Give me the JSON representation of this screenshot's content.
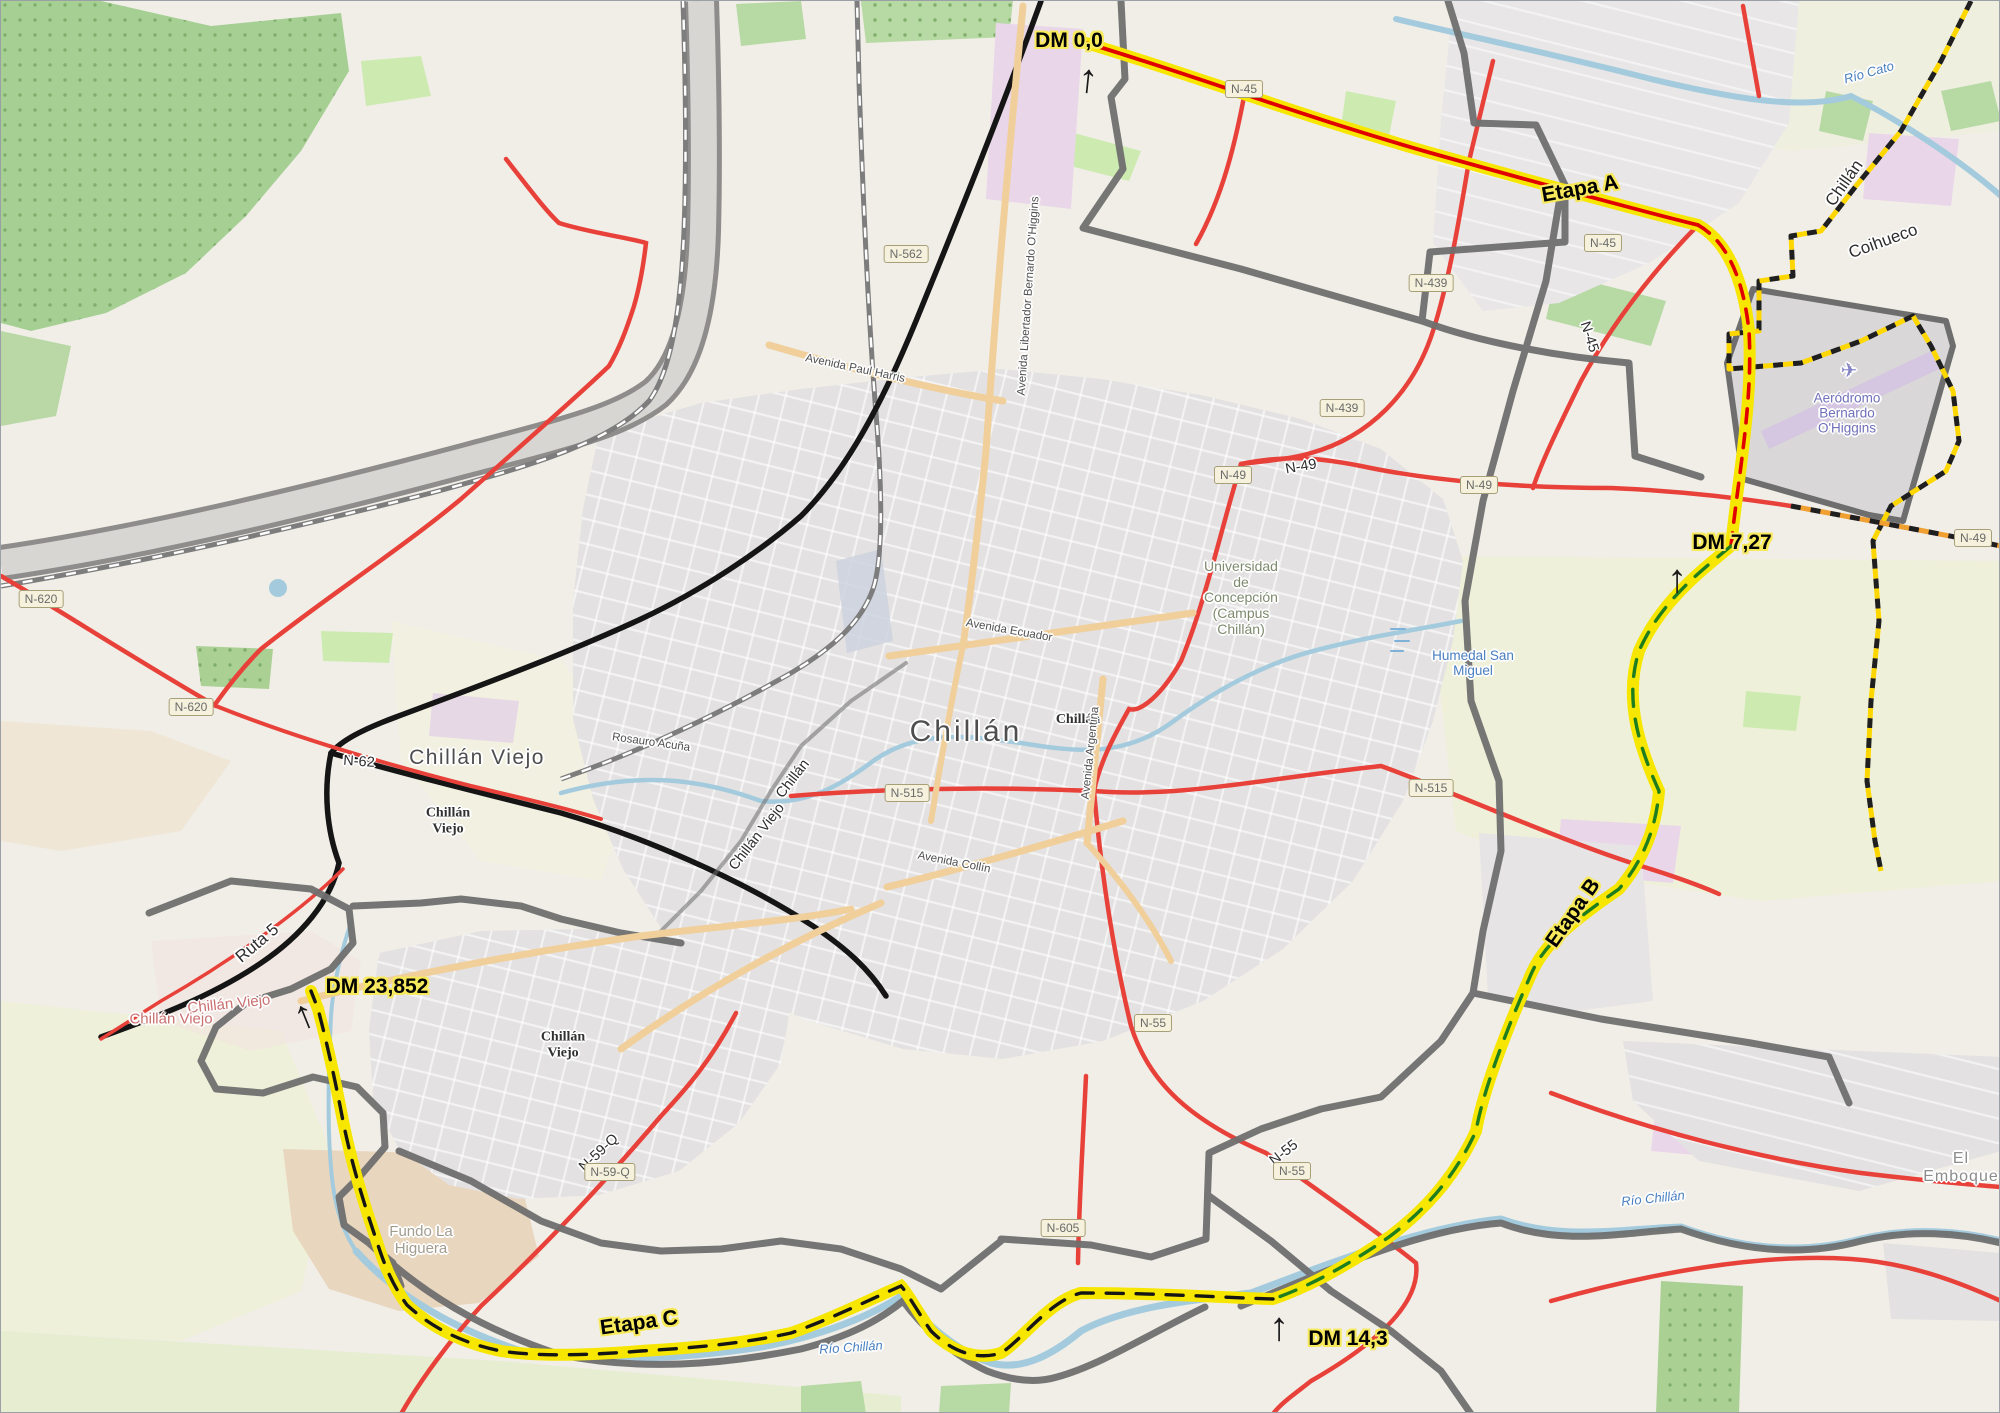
{
  "map": {
    "type": "route-stages-map",
    "area": "Chillán / Chillán Viejo, Chile",
    "route": {
      "highlight_color": "#f7e600",
      "stages": [
        {
          "name": "Etapa A",
          "dash_color": "#e00000"
        },
        {
          "name": "Etapa B",
          "dash_color": "#1e7d1e"
        },
        {
          "name": "Etapa C",
          "dash_color": "#151515"
        }
      ],
      "dm_markers": [
        "DM 0,0",
        "DM 7,27",
        "DM 14,3",
        "DM 23,852"
      ]
    },
    "road_refs": [
      "N-562",
      "N-620",
      "N-45",
      "N-439",
      "N-49",
      "N-515",
      "N-55",
      "N-605",
      "N-59-Q",
      "N-62",
      "Ruta 5"
    ],
    "places": [
      "Chillán",
      "Chillán Viejo",
      "Coihueco",
      "El Emboque",
      "Fundo La Higuera"
    ],
    "pois": [
      "Universidad de Concepción (Campus Chillán)",
      "Aeródromo Bernardo O'Higgins",
      "Humedal San Miguel"
    ],
    "waterways": [
      "Río Cato",
      "Río Chillán"
    ],
    "labels": [
      {
        "n": "dm-0-label",
        "t": "DM 0,0",
        "cls": "dm yhalo",
        "x": 1068,
        "y": 40,
        "r": 0
      },
      {
        "n": "dm-7-label",
        "t": "DM 7,27",
        "cls": "dm yhalo",
        "x": 1731,
        "y": 542,
        "r": 0
      },
      {
        "n": "dm-14-label",
        "t": "DM 14,3",
        "cls": "dm yhalo",
        "x": 1347,
        "y": 1338,
        "r": 0
      },
      {
        "n": "dm-23-label",
        "t": "DM 23,852",
        "cls": "dm yhalo",
        "x": 376,
        "y": 986,
        "r": 0
      },
      {
        "n": "stage-a-label",
        "t": "Etapa A",
        "cls": "stage yhalo",
        "x": 1579,
        "y": 188,
        "r": -10
      },
      {
        "n": "stage-b-label",
        "t": "Etapa B",
        "cls": "stage yhalo",
        "x": 1572,
        "y": 912,
        "r": -55
      },
      {
        "n": "stage-c-label",
        "t": "Etapa C",
        "cls": "stage yhalo",
        "x": 638,
        "y": 1322,
        "r": -8
      },
      {
        "n": "city-chillan",
        "t": "Chillán",
        "cls": "city-lg halo",
        "x": 965,
        "y": 731,
        "r": 0
      },
      {
        "n": "city-chillan-viejo",
        "t": "Chillán Viejo",
        "cls": "city-md halo",
        "x": 476,
        "y": 757,
        "r": 0
      },
      {
        "n": "admin-chillan",
        "t": "Chillán",
        "cls": "admin halo",
        "x": 1077,
        "y": 719,
        "r": 0
      },
      {
        "n": "admin-chillan-viejo-1",
        "t": "Chillán\nViejo",
        "cls": "admin halo",
        "x": 447,
        "y": 820,
        "r": 0
      },
      {
        "n": "admin-chillan-viejo-2",
        "t": "Chillán\nViejo",
        "cls": "admin halo",
        "x": 562,
        "y": 1044,
        "r": 0
      },
      {
        "n": "poi-udec",
        "t": "Universidad\nde\nConcepción\n(Campus\nChillán)",
        "cls": "poi halo",
        "x": 1240,
        "y": 597,
        "r": 0
      },
      {
        "n": "poi-humedal",
        "t": "Humedal San\nMiguel",
        "cls": "water-lbl halo",
        "x": 1472,
        "y": 662,
        "r": 0
      },
      {
        "n": "poi-aerodromo",
        "t": "Aeródromo\nBernardo\nO'Higgins",
        "cls": "aero halo",
        "x": 1846,
        "y": 412,
        "r": 0
      },
      {
        "n": "airplane-icon",
        "t": "✈",
        "cls": "plane halo",
        "x": 1848,
        "y": 370,
        "r": 0
      },
      {
        "n": "river-cato",
        "t": "Río Cato",
        "cls": "river halo",
        "x": 1868,
        "y": 72,
        "r": -16
      },
      {
        "n": "river-chillan-1",
        "t": "Río Chillán",
        "cls": "river halo",
        "x": 1652,
        "y": 1198,
        "r": -6
      },
      {
        "n": "river-chillan-2",
        "t": "Río Chillán",
        "cls": "river halo",
        "x": 850,
        "y": 1347,
        "r": -4
      },
      {
        "n": "locality-el-emboque",
        "t": "El Emboque",
        "cls": "locality halo",
        "x": 1960,
        "y": 1167,
        "r": 0
      },
      {
        "n": "farm-fundo",
        "t": "Fundo La\nHiguera",
        "cls": "farm halo",
        "x": 420,
        "y": 1240,
        "r": 0
      },
      {
        "n": "pink-chillan-viejo-1",
        "t": "Chillán Viejo",
        "cls": "pink-city halo",
        "x": 228,
        "y": 1004,
        "r": -6
      },
      {
        "n": "pink-chillan-viejo-2",
        "t": "Chillán Viejo",
        "cls": "pink-city halo",
        "x": 170,
        "y": 1019,
        "r": 0
      },
      {
        "n": "boundary-chillan-ne",
        "t": "Chillán",
        "cls": "halo-lg halo",
        "x": 1843,
        "y": 182,
        "r": -55
      },
      {
        "n": "boundary-coihueco",
        "t": "Coihueco",
        "cls": "halo-lg halo",
        "x": 1882,
        "y": 240,
        "r": -20
      },
      {
        "n": "boundary-chillan-sw",
        "t": "Chillán",
        "cls": "halo-md halo",
        "x": 792,
        "y": 778,
        "r": -52
      },
      {
        "n": "boundary-chillan-viejo-sw",
        "t": "Chillán Viejo",
        "cls": "halo-md halo",
        "x": 756,
        "y": 836,
        "r": -52
      },
      {
        "n": "ref-ruta5",
        "t": "Ruta 5",
        "cls": "halo-lg halo",
        "x": 256,
        "y": 942,
        "r": -40
      },
      {
        "n": "ref-n62",
        "t": "N-62",
        "cls": "halo-md halo",
        "x": 358,
        "y": 761,
        "r": 4
      },
      {
        "n": "ref-n49",
        "t": "N-49",
        "cls": "halo-md halo",
        "x": 1300,
        "y": 466,
        "r": -10
      },
      {
        "n": "ref-n45",
        "t": "N-45",
        "cls": "halo-md halo",
        "x": 1588,
        "y": 336,
        "r": 72
      },
      {
        "n": "ref-n55",
        "t": "N-55",
        "cls": "halo-md halo",
        "x": 1283,
        "y": 1152,
        "r": -38
      },
      {
        "n": "ref-n59q",
        "t": "N-59-Q",
        "cls": "halo-md halo",
        "x": 598,
        "y": 1152,
        "r": -43
      },
      {
        "n": "street-ohiggins",
        "t": "Avenida Libertador Bernardo O'Higgins",
        "cls": "street halo",
        "x": 1028,
        "y": 295,
        "r": -86
      },
      {
        "n": "street-paul-harris",
        "t": "Avenida Paul Harris",
        "cls": "street halo",
        "x": 854,
        "y": 368,
        "r": 12
      },
      {
        "n": "street-ecuador",
        "t": "Avenida Ecuador",
        "cls": "street halo",
        "x": 1008,
        "y": 630,
        "r": 10
      },
      {
        "n": "street-argentina",
        "t": "Avenida Argentina",
        "cls": "street halo",
        "x": 1090,
        "y": 752,
        "r": -84
      },
      {
        "n": "street-collin",
        "t": "Avenida Collín",
        "cls": "street halo",
        "x": 953,
        "y": 862,
        "r": 11
      },
      {
        "n": "street-rosauro",
        "t": "Rosauro Acuña",
        "cls": "street halo",
        "x": 650,
        "y": 742,
        "r": 8
      }
    ],
    "shields": [
      {
        "t": "N-562",
        "x": 905,
        "y": 253
      },
      {
        "t": "N-620",
        "x": 40,
        "y": 598
      },
      {
        "t": "N-620",
        "x": 190,
        "y": 706
      },
      {
        "t": "N-45",
        "x": 1243,
        "y": 88
      },
      {
        "t": "N-45",
        "x": 1602,
        "y": 242
      },
      {
        "t": "N-439",
        "x": 1430,
        "y": 282
      },
      {
        "t": "N-439",
        "x": 1341,
        "y": 407
      },
      {
        "t": "N-49",
        "x": 1232,
        "y": 474
      },
      {
        "t": "N-49",
        "x": 1478,
        "y": 484
      },
      {
        "t": "N-49",
        "x": 1972,
        "y": 537
      },
      {
        "t": "N-515",
        "x": 1430,
        "y": 787
      },
      {
        "t": "N-515",
        "x": 906,
        "y": 792
      },
      {
        "t": "N-55",
        "x": 1152,
        "y": 1022
      },
      {
        "t": "N-55",
        "x": 1291,
        "y": 1170
      },
      {
        "t": "N-605",
        "x": 1062,
        "y": 1227
      },
      {
        "t": "N-59-Q",
        "x": 609,
        "y": 1171
      }
    ],
    "arrows": [
      {
        "n": "dm-0-arrow",
        "x": 1087,
        "y": 78,
        "r": 6
      },
      {
        "n": "dm-7-arrow",
        "x": 1676,
        "y": 578,
        "r": 0
      },
      {
        "n": "dm-14-arrow",
        "x": 1278,
        "y": 1326,
        "r": 0
      },
      {
        "n": "dm-23-arrow",
        "x": 303,
        "y": 1014,
        "r": -22
      }
    ]
  }
}
